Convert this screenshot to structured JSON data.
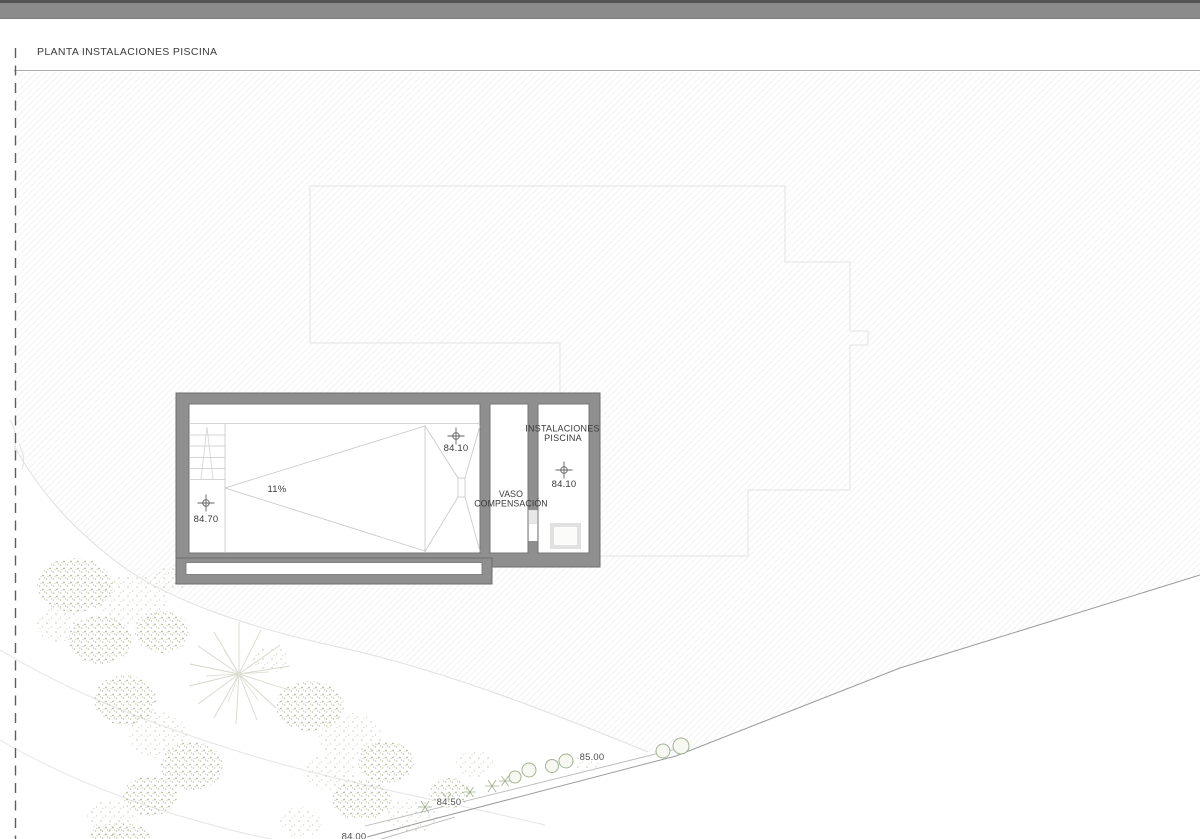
{
  "title": "PLANTA INSTALACIONES PISCINA",
  "plan": {
    "slope_label": "11%",
    "levels": {
      "pool_deep": "84.10",
      "pool_shallow": "84.70",
      "plant_room": "84.10"
    },
    "rooms": {
      "vaso_line1": "VASO",
      "vaso_line2": "COMPENSACIÓN",
      "plant_line1": "INSTALACIONES",
      "plant_line2": "PISCINA"
    }
  },
  "contours": {
    "c85": "85.00",
    "c845": "84.50",
    "c84": "84.00"
  },
  "colors": {
    "topbar": "#8b8b8b",
    "topbar_edge": "#545454",
    "wall": "#8f8f8f",
    "wall_edge": "#6c6c6c",
    "ink": "#3a3a3a",
    "contour_line": "#9b9b9b",
    "vegetation": "#aeb795"
  }
}
